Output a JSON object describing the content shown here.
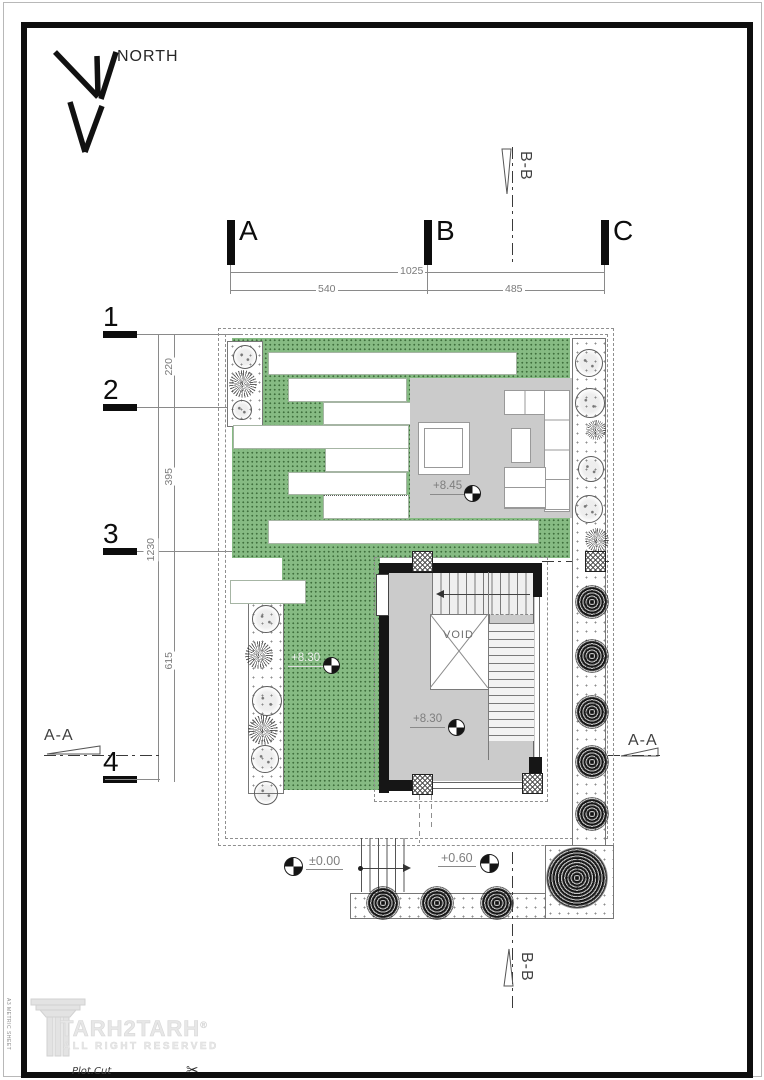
{
  "north": {
    "label": "NORTH"
  },
  "grid": {
    "cols": [
      "A",
      "B",
      "C"
    ],
    "rows": [
      "1",
      "2",
      "3",
      "4"
    ]
  },
  "dims": {
    "top_total": "1025",
    "top_segments": [
      "540",
      "485"
    ],
    "left_total": "1230",
    "left_segments": [
      "220",
      "395",
      "615"
    ]
  },
  "sections": {
    "aa": "A-A",
    "bb": "B-B"
  },
  "levels": {
    "terrace": "+8.45",
    "lawn": "+8.30",
    "stair": "+8.30",
    "ground": "±0.00",
    "entry": "+0.60"
  },
  "core": {
    "void_label": "VOID"
  },
  "logo": {
    "name": "TARH2TARH",
    "reg": "®",
    "tagline": "ALL RIGHT RESERVED"
  },
  "footer": {
    "plot_cut": "Plot.Cut",
    "scissors": "✂",
    "edge_note": "A3 METRIC SHEET"
  },
  "colors": {
    "lawn": "#86bb83",
    "terrace": "#cbcbcb",
    "wall": "#161616",
    "dim_text": "#7b7b7b",
    "paving_dot": "#8c8c8c"
  }
}
